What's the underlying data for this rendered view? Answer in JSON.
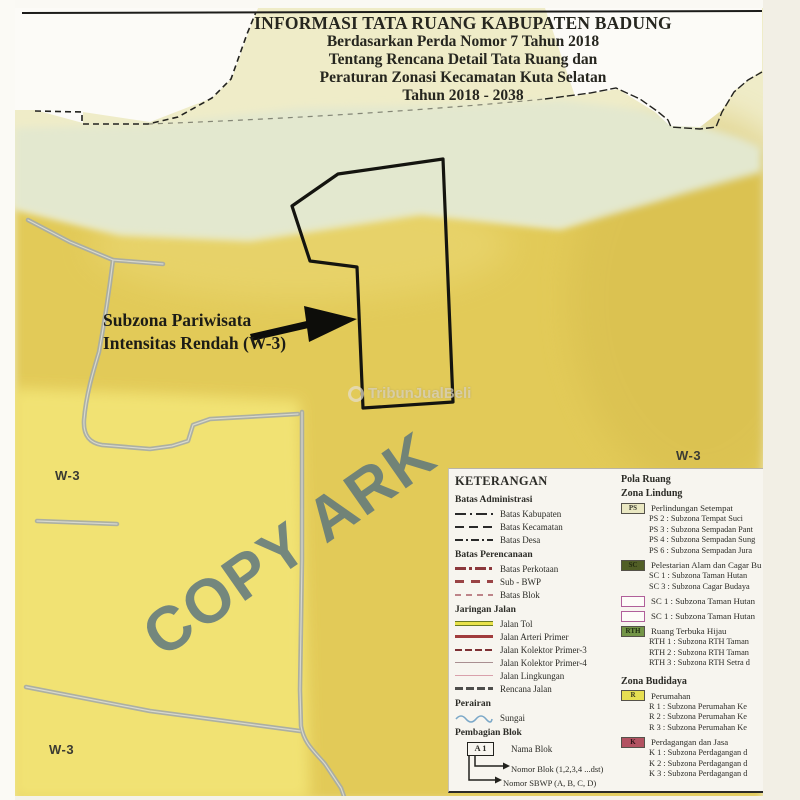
{
  "title_block": {
    "line1": "INFORMASI TATA RUANG KABUPATEN BADUNG",
    "line2": "Berdasarkan Perda Nomor 7 Tahun 2018",
    "line3": "Tentang Rencana Detail Tata Ruang dan",
    "line4": "Peraturan Zonasi Kecamatan Kuta Selatan",
    "line5": "Tahun 2018 - 2038"
  },
  "map": {
    "parcel_label_line1": "Subzona Pariwisata",
    "parcel_label_line2": "Intensitas Rendah (W-3)",
    "zone_label_left": "W-3",
    "zone_label_right": "W-3",
    "zone_label_bottom": "W-3",
    "watermark": "COPY ARK",
    "photo_watermark": "TribunJualBeli",
    "colors": {
      "golden_zone": "#e2ca58",
      "light_yellow_zone": "#f3e577",
      "pale_green_zone": "#e3e8cf",
      "cream_zone": "#efecc8",
      "road": "#a6aba6",
      "watermark_blue_gray": "#557080"
    }
  },
  "legend": {
    "title": "KETERANGAN",
    "batas_administrasi": {
      "heading": "Batas Administrasi",
      "items": [
        "Batas Kabupaten",
        "Batas Kecamatan",
        "Batas Desa"
      ]
    },
    "batas_perencanaan": {
      "heading": "Batas Perencanaan",
      "items": [
        "Batas Perkotaan",
        "Sub - BWP",
        "Batas Blok"
      ]
    },
    "jaringan_jalan": {
      "heading": "Jaringan Jalan",
      "items": [
        "Jalan Tol",
        "Jalan Arteri Primer",
        "Jalan Kolektor Primer-3",
        "Jalan Kolektor Primer-4",
        "Jalan Lingkungan",
        "Rencana Jalan"
      ]
    },
    "perairan": {
      "heading": "Perairan",
      "items": [
        "Sungai"
      ]
    },
    "pembagian_blok": {
      "heading": "Pembagian Blok",
      "block_code": "A 1",
      "nama_blok": "Nama Blok",
      "nomor_blok": "Nomor Blok (1,2,3,4 ...dst)",
      "nomor_sbwp": "Nomor SBWP (A, B, C, D)"
    },
    "pola_ruang": {
      "heading": "Pola Ruang",
      "zona_lindung": {
        "heading": "Zona Lindung",
        "ps": {
          "code": "PS",
          "heading": "Perlindungan Setempat",
          "items": [
            "PS 2 : Subzona Tempat Suci",
            "PS 3 : Subzona Sempadan Pant",
            "PS 4 : Subzona Sempadan Sung",
            "PS 6 : Subzona Sempadan Jura"
          ]
        },
        "sc": {
          "code": "SC",
          "heading": "Pelestarian Alam dan Cagar Bu",
          "items": [
            "SC 1 : Subzona Taman Hutan",
            "SC 3 : Subzona Cagar Budaya"
          ]
        },
        "sc_outline1": {
          "label": "SC 1 : Subzona Taman Hutan"
        },
        "sc_outline2": {
          "label": "SC 1 : Subzona Taman Hutan"
        },
        "rth": {
          "code": "RTH",
          "heading": "Ruang Terbuka Hijau",
          "items": [
            "RTH 1 : Subzona RTH Taman",
            "RTH 2 : Subzona RTH Taman",
            "RTH 3 : Subzona RTH Setra d"
          ]
        }
      },
      "zona_budidaya": {
        "heading": "Zona Budidaya",
        "r": {
          "code": "R",
          "heading": "Perumahan",
          "items": [
            "R 1 : Subzona Perumahan Ke",
            "R 2 : Subzona Perumahan Ke",
            "R 3 : Subzona Perumahan Ke"
          ]
        },
        "k": {
          "code": "K",
          "heading": "Perdagangan dan Jasa",
          "items": [
            "K 1 : Subzona Perdagangan d",
            "K 2 : Subzona Perdagangan d",
            "K 3 : Subzona Perdagangan d"
          ]
        }
      }
    }
  }
}
